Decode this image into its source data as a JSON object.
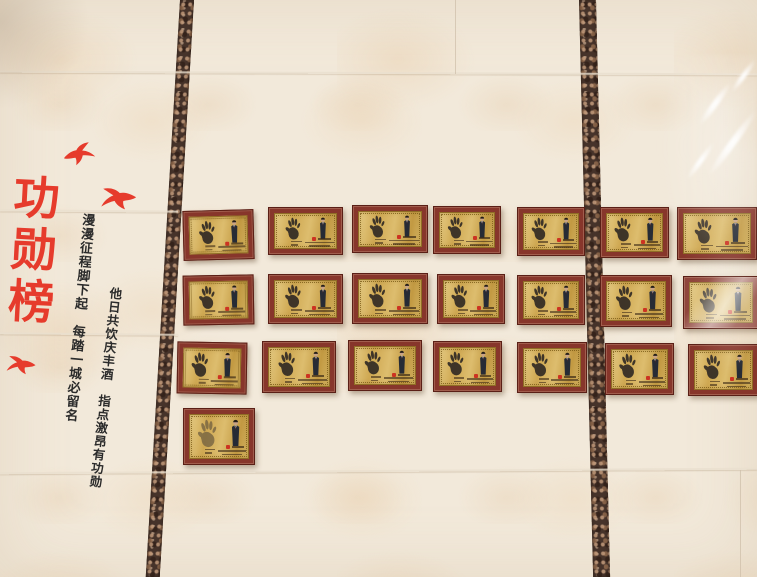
{
  "scene_title": "功勋榜",
  "title": {
    "chars": [
      "功",
      "勋",
      "榜"
    ],
    "color": "#e63b2c"
  },
  "calligraphy": {
    "left_column": "漫漫征程脚下起　每踏一城必留名",
    "right_column": "他日共饮庆丰酒　指点激昂有功勋",
    "ink_color": "#2b2b2b"
  },
  "birds": [
    {
      "x": 62,
      "y": 142,
      "w": 33,
      "h": 26,
      "rotate": -6,
      "flip": false
    },
    {
      "x": 100,
      "y": 185,
      "w": 38,
      "h": 28,
      "rotate": 12,
      "flip": true
    },
    {
      "x": 6,
      "y": 352,
      "w": 31,
      "h": 27,
      "rotate": 8,
      "flip": true
    }
  ],
  "palette": {
    "wall": "#f2e9da",
    "marble_stripe": "#46332a",
    "frame_red": "#87362b",
    "plate_gold": "#d3b263",
    "accent_red": "#e63b2c",
    "handprint": "#332c25"
  },
  "plaques": {
    "total": 22,
    "rows": [
      [
        {
          "x": 183,
          "y": 210,
          "w": 69,
          "h": 48,
          "tilt": -1.5
        },
        {
          "x": 268,
          "y": 207,
          "w": 73,
          "h": 46,
          "tilt": 0
        },
        {
          "x": 352,
          "y": 205,
          "w": 74,
          "h": 46,
          "tilt": 0
        },
        {
          "x": 433,
          "y": 206,
          "w": 66,
          "h": 46,
          "tilt": 0
        },
        {
          "x": 517,
          "y": 207,
          "w": 66,
          "h": 47,
          "tilt": 0
        },
        {
          "x": 600,
          "y": 207,
          "w": 67,
          "h": 49,
          "tilt": 0
        },
        {
          "x": 677,
          "y": 207,
          "w": 78,
          "h": 51,
          "tilt": 0
        }
      ],
      [
        {
          "x": 183,
          "y": 275,
          "w": 69,
          "h": 48,
          "tilt": -1
        },
        {
          "x": 268,
          "y": 274,
          "w": 73,
          "h": 48,
          "tilt": 0
        },
        {
          "x": 352,
          "y": 273,
          "w": 74,
          "h": 49,
          "tilt": 0
        },
        {
          "x": 437,
          "y": 274,
          "w": 66,
          "h": 48,
          "tilt": 0
        },
        {
          "x": 517,
          "y": 275,
          "w": 66,
          "h": 48,
          "tilt": 0
        },
        {
          "x": 600,
          "y": 275,
          "w": 70,
          "h": 50,
          "tilt": 0
        },
        {
          "x": 683,
          "y": 276,
          "w": 74,
          "h": 51,
          "tilt": 0,
          "variant": "glossy"
        }
      ],
      [
        {
          "x": 177,
          "y": 342,
          "w": 68,
          "h": 50,
          "tilt": 1
        },
        {
          "x": 262,
          "y": 341,
          "w": 72,
          "h": 50,
          "tilt": 0
        },
        {
          "x": 348,
          "y": 340,
          "w": 72,
          "h": 49,
          "tilt": 0
        },
        {
          "x": 433,
          "y": 341,
          "w": 67,
          "h": 49,
          "tilt": 0
        },
        {
          "x": 517,
          "y": 342,
          "w": 68,
          "h": 49,
          "tilt": 0
        },
        {
          "x": 605,
          "y": 343,
          "w": 67,
          "h": 50,
          "tilt": 0
        },
        {
          "x": 688,
          "y": 344,
          "w": 69,
          "h": 50,
          "tilt": 0
        }
      ],
      [
        {
          "x": 183,
          "y": 408,
          "w": 70,
          "h": 55,
          "tilt": 0,
          "variant": "faded"
        }
      ]
    ]
  }
}
